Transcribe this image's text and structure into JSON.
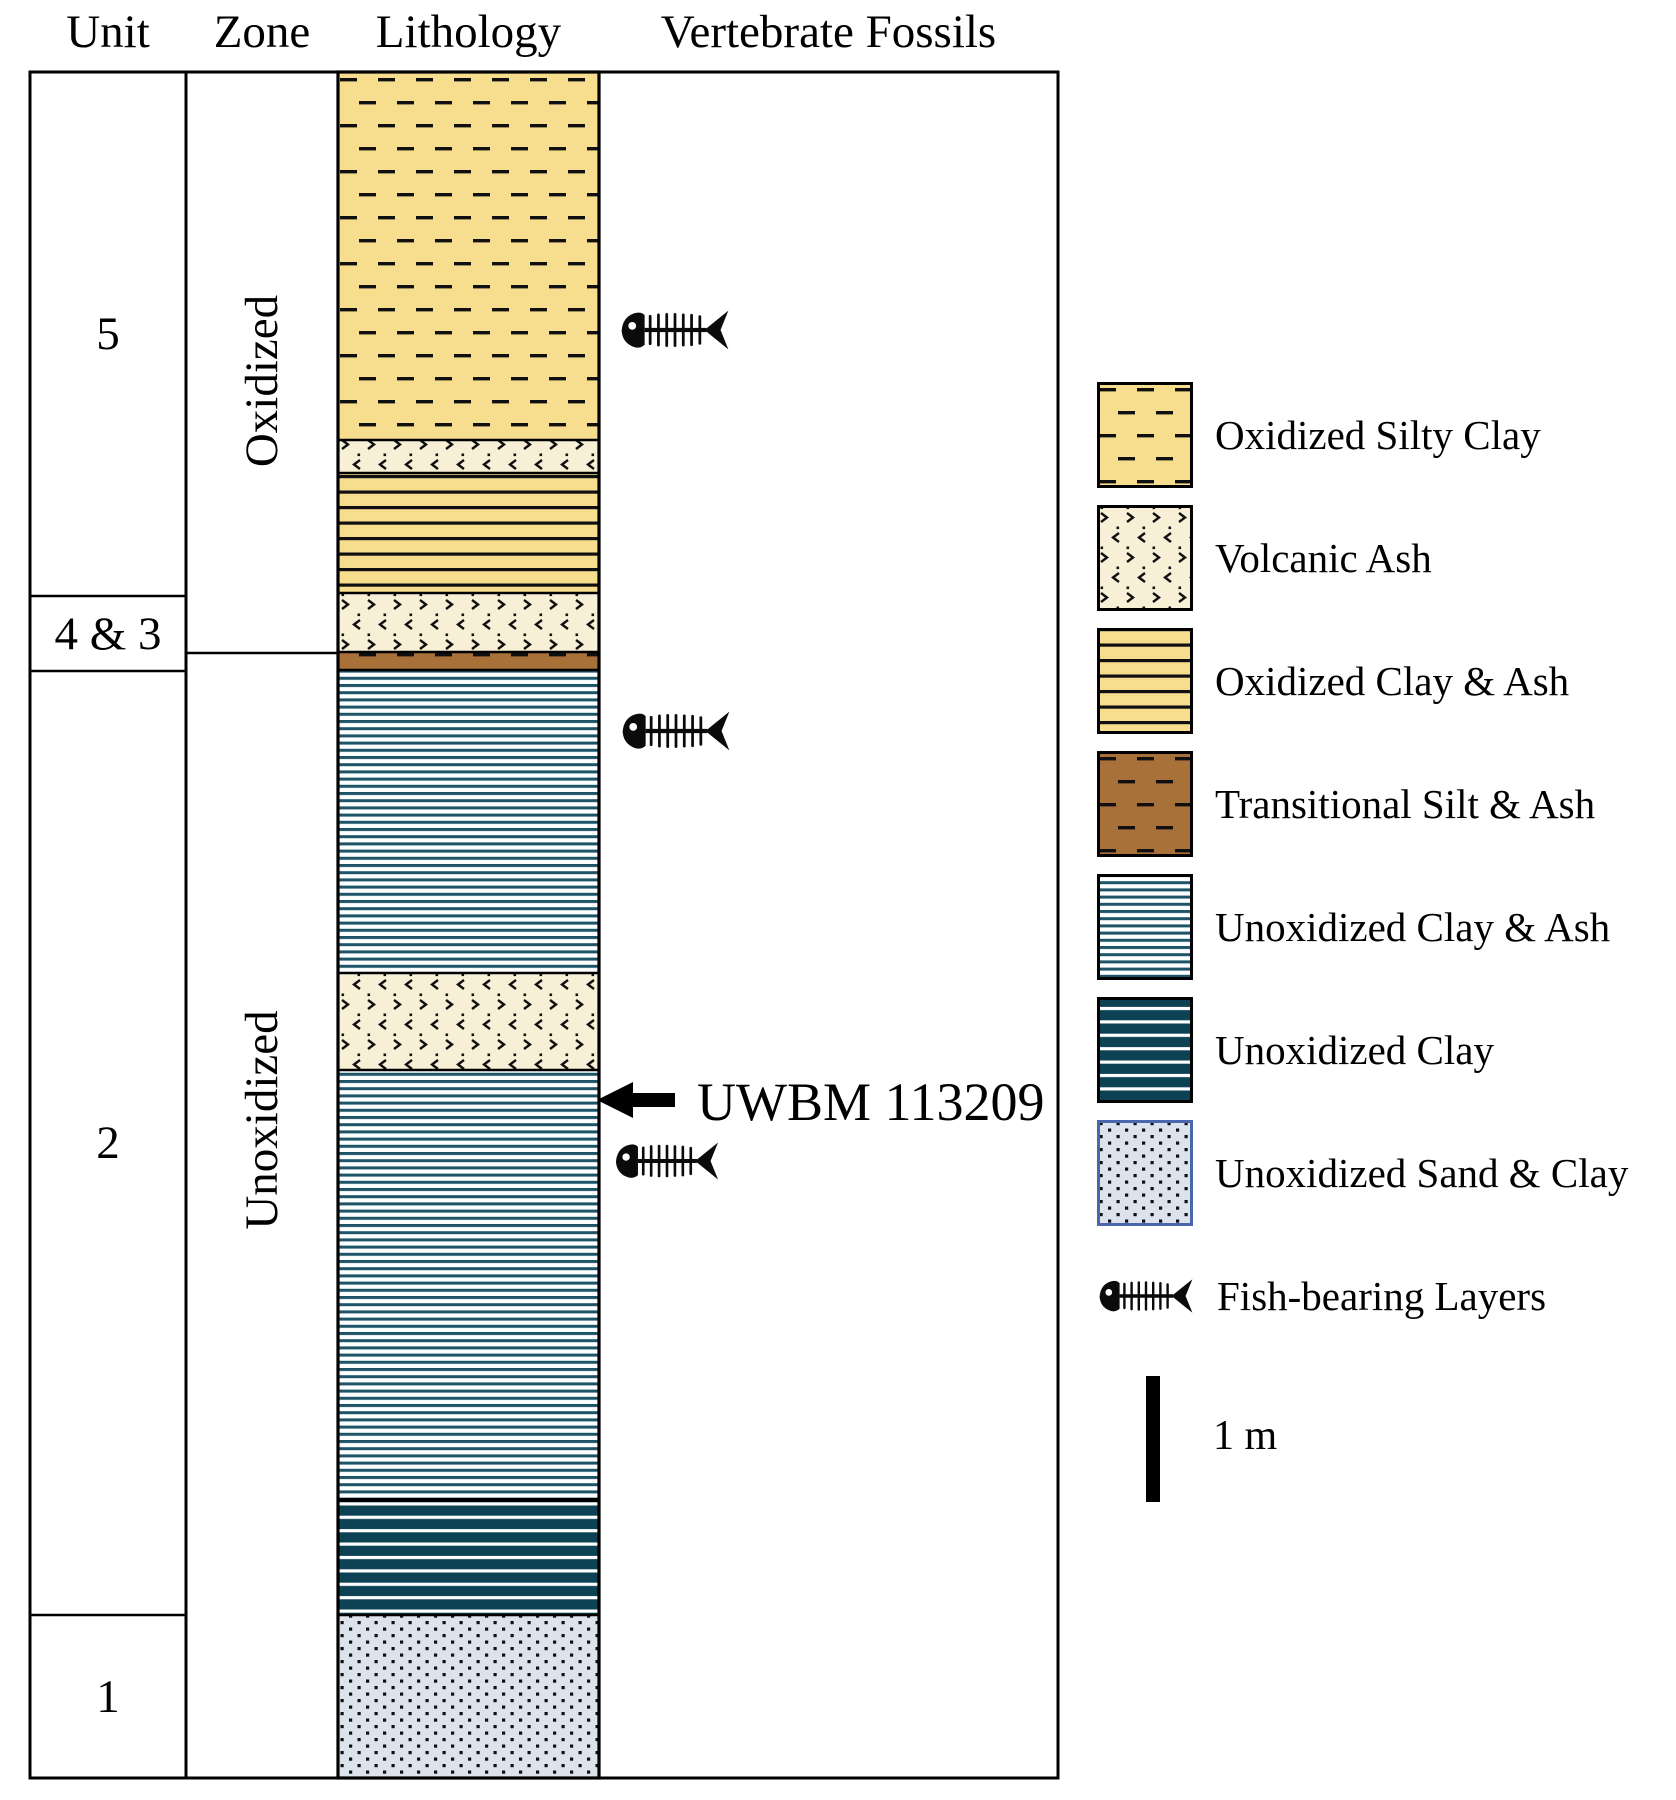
{
  "figure": {
    "headers": {
      "unit": "Unit",
      "zone": "Zone",
      "lithology": "Lithology",
      "fossils": "Vertebrate Fossils"
    },
    "units": [
      {
        "label": "5"
      },
      {
        "label": "4 & 3"
      },
      {
        "label": "2"
      },
      {
        "label": "1"
      }
    ],
    "zones": [
      {
        "label": "Oxidized"
      },
      {
        "label": "Unoxidized"
      }
    ],
    "specimen": {
      "label": "UWBM 113209"
    }
  },
  "strat_column": {
    "layers_top_to_bottom": [
      {
        "lithology": "Oxidized Silty Clay",
        "unit": "5",
        "zone": "Oxidized",
        "height_px": 368
      },
      {
        "lithology": "Volcanic Ash",
        "unit": "5",
        "zone": "Oxidized",
        "height_px": 33
      },
      {
        "lithology": "Oxidized Clay & Ash",
        "unit": "5",
        "zone": "Oxidized",
        "height_px": 120
      },
      {
        "lithology": "Volcanic Ash",
        "unit": "4 & 3",
        "zone": "Oxidized",
        "height_px": 59
      },
      {
        "lithology": "Transitional Silt & Ash",
        "unit": "4 & 3",
        "zone": "Unoxidized",
        "height_px": 18
      },
      {
        "lithology": "Unoxidized Clay & Ash",
        "unit": "2",
        "zone": "Unoxidized",
        "height_px": 303
      },
      {
        "lithology": "Volcanic Ash",
        "unit": "2",
        "zone": "Unoxidized",
        "height_px": 97
      },
      {
        "lithology": "Unoxidized Clay & Ash",
        "unit": "2",
        "zone": "Unoxidized",
        "height_px": 430
      },
      {
        "lithology": "Unoxidized Clay",
        "unit": "2",
        "zone": "Unoxidized",
        "height_px": 115
      },
      {
        "lithology": "Unoxidized Sand & Clay",
        "unit": "1",
        "zone": "Unoxidized",
        "height_px": 163
      }
    ],
    "fish_bearing_layers": [
      "Oxidized Silty Clay (upper)",
      "Unoxidized Clay & Ash (upper)",
      "Unoxidized Clay & Ash (below UWBM 113209)"
    ],
    "specimen_marker": "UWBM 113209 arrow points to Unoxidized Clay & Ash just below middle Volcanic Ash bed"
  },
  "legend": {
    "items": [
      {
        "label": "Oxidized Silty Clay",
        "pattern": "dashed-yellow"
      },
      {
        "label": "Volcanic Ash",
        "pattern": "chevron-cream"
      },
      {
        "label": "Oxidized Clay & Ash",
        "pattern": "lined-yellow"
      },
      {
        "label": "Transitional Silt & Ash",
        "pattern": "dashed-brown"
      },
      {
        "label": "Unoxidized Clay & Ash",
        "pattern": "thin-teal-lines"
      },
      {
        "label": "Unoxidized Clay",
        "pattern": "dark-teal-white-lines"
      },
      {
        "label": "Unoxidized Sand & Clay",
        "pattern": "dotted-gray"
      },
      {
        "label": "Fish-bearing Layers",
        "pattern": "fish-skeleton"
      }
    ],
    "scale_bar_label": "1 m"
  },
  "colors": {
    "oxidized_yellow": "#F7DE8E",
    "ash_cream": "#F8F0D6",
    "mark_black": "#101010",
    "transitional_brown": "#A9713A",
    "unox_line_teal": "#1D5467",
    "unox_bg_white": "#FDFEFE",
    "unox_dark_teal": "#0C4254",
    "white_line": "#FFFFFF",
    "sand_bg": "#DCE3EC",
    "sand_border_blue": "#4A67AE",
    "line_black": "#000000"
  }
}
